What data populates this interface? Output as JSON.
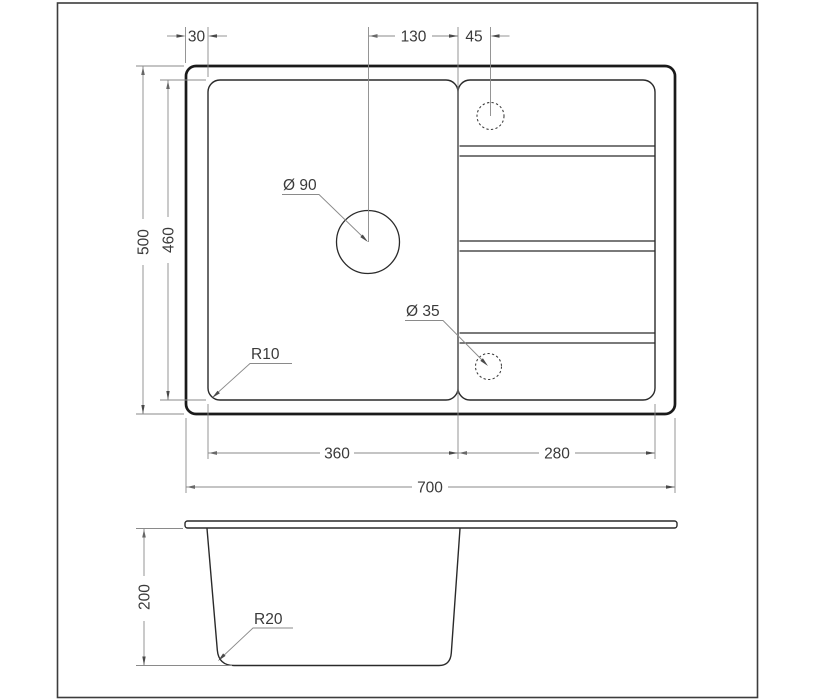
{
  "title": "Sink dimensional drawing",
  "top_view": {
    "dim_rim_offset": "30",
    "dim_drain_to_divider": "130",
    "dim_divider_to_tap": "45",
    "dim_overall_depth": "500",
    "dim_inner_depth": "460",
    "label_drain_hole": "Ø 90",
    "label_tap_hole": "Ø 35",
    "label_corner_radius": "R10",
    "dim_bowl_width": "360",
    "dim_drainboard_width": "280",
    "dim_overall_width": "700"
  },
  "section_view": {
    "dim_bowl_depth": "200",
    "label_bottom_radius": "R20"
  },
  "colors": {
    "outline": "#1a1a1a",
    "dimension_lines": "#8a8a8a",
    "text": "#3a3a3a",
    "background": "#ffffff"
  }
}
